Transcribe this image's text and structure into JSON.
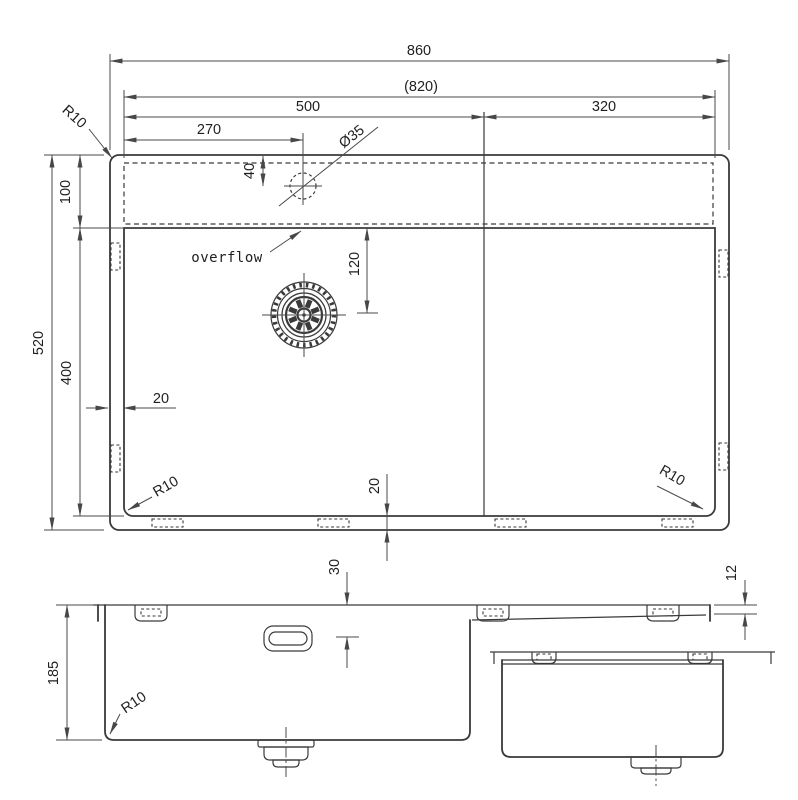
{
  "colors": {
    "background": "#ffffff",
    "object_line": "#3a3a3a",
    "dimension_line": "#4a4a4a",
    "text": "#1f1f1f"
  },
  "top_view": {
    "width_total": "860",
    "width_inner": "(820)",
    "width_bowl": "500",
    "width_right": "320",
    "tap_offset": "270",
    "tap_diameter": "Ø35",
    "tap_from_edge": "40",
    "deck_depth": "100",
    "depth_total": "520",
    "bowl_length": "400",
    "rim_left": "20",
    "rim_bottom": "20",
    "drain_offset": "120",
    "radius_top_left": "R10",
    "radius_bowl_left": "R10",
    "radius_bowl_right": "R10",
    "overflow_label": "overflow"
  },
  "front_view": {
    "bowl_depth": "185",
    "overflow_drop": "30",
    "radius_bottom": "R10"
  },
  "side_view": {
    "ledge_drop": "12"
  }
}
